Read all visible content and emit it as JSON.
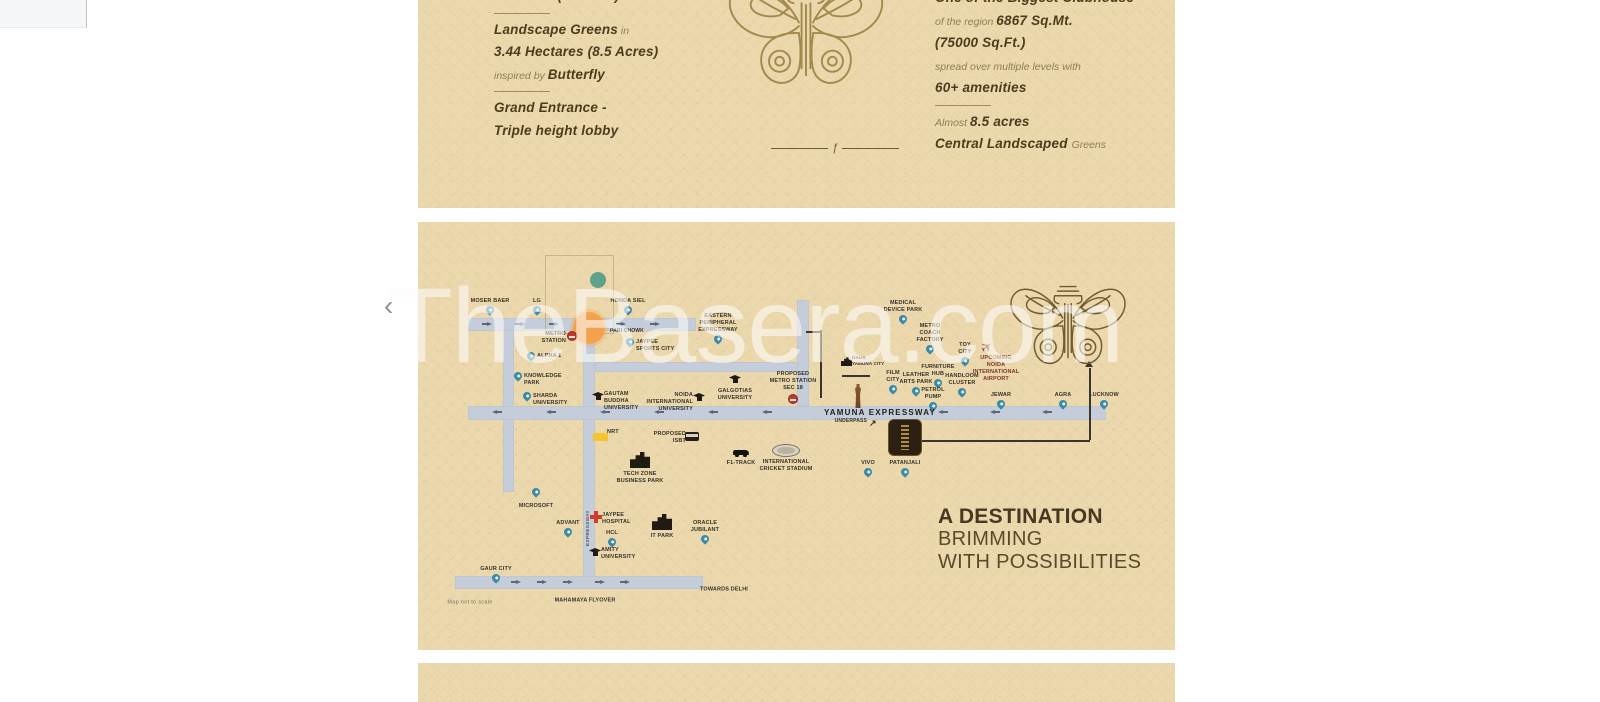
{
  "watermark": {
    "text": "TheBasera.com"
  },
  "carousel": {
    "prev": "‹"
  },
  "features": {
    "left": [
      {
        "bold": "7 Towers (Phase 1)"
      },
      {
        "tpl": "divider"
      },
      {
        "bold": "Landscape Greens",
        "post": " in"
      },
      {
        "bold": "3.44 Hectares (8.5 Acres)"
      },
      {
        "pre": "inspired by ",
        "bold": "Butterfly"
      },
      {
        "tpl": "divider"
      },
      {
        "bold": "Grand Entrance -"
      },
      {
        "bold": "Triple height lobby"
      }
    ],
    "right": [
      {
        "bold": "One of the Biggest Clubhouse"
      },
      {
        "pre": "of the region ",
        "bold": "6867 Sq.Mt."
      },
      {
        "bold": "(75000 Sq.Ft.)"
      },
      {
        "pre": "spread over multiple levels with"
      },
      {
        "bold": "60+ amenities"
      },
      {
        "tpl": "divider"
      },
      {
        "pre": "Almost ",
        "bold": "8.5 acres"
      },
      {
        "bold": "Central Landscaped ",
        "post": "Greens"
      }
    ]
  },
  "ornament": {
    "divider_glyph": "ƒ"
  },
  "map": {
    "headline": {
      "l1": "A DESTINATION",
      "l2": "BRIMMING",
      "l3": "WITH POSSIBILITIES"
    },
    "colors": {
      "card_beige": "#ecd8ad",
      "road": "#c4cdd9",
      "pin_teal": "#3c8aa5",
      "junction_orange": "#f2a24b",
      "metro_red": "#bf3a2c",
      "airport_maroon": "#7d3526",
      "ornament_gold": "#a28a4e",
      "logo_brown": "#6e5a33",
      "text_olive": "#4c3c1e"
    },
    "roads": [
      {
        "name": "road-parichowk-west",
        "x": 468,
        "y": 318,
        "w": 228,
        "h": 13
      },
      {
        "name": "road-main-vertical",
        "x": 583,
        "y": 330,
        "w": 12,
        "h": 252
      },
      {
        "name": "road-left-vertical",
        "x": 503,
        "y": 330,
        "w": 11,
        "h": 162
      },
      {
        "name": "road-mid-horizontal",
        "x": 595,
        "y": 362,
        "w": 203,
        "h": 10
      },
      {
        "name": "road-yamuna-expressway",
        "x": 468,
        "y": 406,
        "w": 638,
        "h": 14
      },
      {
        "name": "road-epe-vertical",
        "x": 797,
        "y": 300,
        "w": 12,
        "h": 106
      },
      {
        "name": "road-mahamaya",
        "x": 455,
        "y": 576,
        "w": 248,
        "h": 13
      },
      {
        "name": "sector-boundary",
        "x": 545,
        "y": 255,
        "w": 67,
        "h": 77,
        "cls": "boundary"
      },
      {
        "name": "rail-line-vertical",
        "x": 820,
        "y": 330,
        "w": 2,
        "h": 68,
        "cls": "dark"
      },
      {
        "name": "rail-line-horizontal",
        "x": 842,
        "y": 375,
        "w": 28,
        "h": 2,
        "cls": "dark"
      },
      {
        "name": "rail-line-top",
        "x": 806,
        "y": 331,
        "w": 15,
        "h": 2,
        "cls": "dark"
      },
      {
        "name": "connector-horizontal",
        "x": 922,
        "y": 440,
        "w": 168,
        "h": 2,
        "cls": "dark"
      },
      {
        "name": "connector-vertical",
        "x": 1089,
        "y": 368,
        "w": 2,
        "h": 72,
        "cls": "dark"
      },
      {
        "name": "connector-arrowhead",
        "x": 1085,
        "y": 361,
        "cls": "arr arr-u"
      },
      {
        "name": "arrow",
        "x": 487,
        "y": 322,
        "cls": "arr arr-r"
      },
      {
        "name": "arrow",
        "x": 520,
        "y": 322,
        "cls": "arr arr-r"
      },
      {
        "name": "arrow",
        "x": 554,
        "y": 322,
        "cls": "arr arr-r"
      },
      {
        "name": "arrow",
        "x": 621,
        "y": 322,
        "cls": "arr arr-r"
      },
      {
        "name": "arrow",
        "x": 655,
        "y": 322,
        "cls": "arr arr-r"
      },
      {
        "name": "arrow",
        "x": 492,
        "y": 410,
        "cls": "arr arr-l"
      },
      {
        "name": "arrow",
        "x": 546,
        "y": 410,
        "cls": "arr arr-l"
      },
      {
        "name": "arrow",
        "x": 600,
        "y": 410,
        "cls": "arr arr-l"
      },
      {
        "name": "arrow",
        "x": 654,
        "y": 410,
        "cls": "arr arr-l"
      },
      {
        "name": "arrow",
        "x": 708,
        "y": 410,
        "cls": "arr arr-l"
      },
      {
        "name": "arrow",
        "x": 762,
        "y": 410,
        "cls": "arr arr-l"
      },
      {
        "name": "arrow",
        "x": 938,
        "y": 410,
        "cls": "arr arr-l"
      },
      {
        "name": "arrow",
        "x": 990,
        "y": 410,
        "cls": "arr arr-l"
      },
      {
        "name": "arrow",
        "x": 1042,
        "y": 410,
        "cls": "arr arr-l"
      },
      {
        "name": "arrow",
        "x": 516,
        "y": 580,
        "cls": "arr arr-r"
      },
      {
        "name": "arrow",
        "x": 542,
        "y": 580,
        "cls": "arr arr-r"
      },
      {
        "name": "arrow",
        "x": 568,
        "y": 580,
        "cls": "arr arr-r"
      },
      {
        "name": "arrow",
        "x": 600,
        "y": 580,
        "cls": "arr arr-r"
      },
      {
        "name": "arrow",
        "x": 625,
        "y": 580,
        "cls": "arr arr-r"
      }
    ],
    "markers": [
      {
        "name": "pin-moser-baer",
        "icon": "pin",
        "x": 490,
        "y": 318,
        "lp": "la",
        "label": "MOSER BAER"
      },
      {
        "name": "pin-lg",
        "icon": "pin",
        "x": 537,
        "y": 318,
        "lp": "la",
        "label": "LG"
      },
      {
        "name": "pin-honda-siel",
        "icon": "pin",
        "x": 628,
        "y": 318,
        "lp": "la",
        "label": "HONDA SIEL"
      },
      {
        "name": "pari-chowk-junction",
        "icon": "ocirc",
        "x": 589,
        "y": 328,
        "lp": "lr",
        "cls": "pc t5",
        "label": "PARI CHOWK"
      },
      {
        "name": "sector-green-dot",
        "icon": "gcirc",
        "x": 598,
        "y": 280,
        "lp": "lc",
        "label": ""
      },
      {
        "name": "metro-station",
        "icon": "metro",
        "x": 572,
        "y": 342,
        "lp": "ll",
        "label": "METRO\nSTATION"
      },
      {
        "name": "pin-alpha-1",
        "icon": "pin",
        "x": 531,
        "y": 364,
        "lp": "lr",
        "label": "ALPHA 1"
      },
      {
        "name": "pin-knowledge-park",
        "icon": "pin",
        "x": 518,
        "y": 384,
        "lp": "lr",
        "label": "KNOWLEDGE\nPARK"
      },
      {
        "name": "pin-sharda-university",
        "icon": "pin",
        "x": 527,
        "y": 404,
        "lp": "lr",
        "label": "SHARDA\nUNIVERSITY"
      },
      {
        "name": "pin-jaypee-sports-city",
        "icon": "pin",
        "x": 630,
        "y": 350,
        "lp": "lr",
        "label": "JAYPEE\nSPORTS CITY"
      },
      {
        "name": "pin-eastern-peripheral-expressway",
        "icon": "pin",
        "x": 718,
        "y": 347,
        "lp": "la",
        "label": "EASTERN\nPERIPHERAL\nEXPRESSWAY"
      },
      {
        "name": "grad-gautam-buddha-university",
        "icon": "grad",
        "x": 598,
        "y": 402,
        "lp": "lr",
        "label": "GAUTAM\nBUDDHA\nUNIVERSITY"
      },
      {
        "name": "grad-noida-international-university",
        "icon": "grad",
        "x": 699,
        "y": 403,
        "lp": "ll",
        "label": "NOIDA\nINTERNATIONAL\nUNIVERSITY"
      },
      {
        "name": "grad-galgotias-university",
        "icon": "grad",
        "x": 735,
        "y": 385,
        "lp": "lb",
        "label": "GALGOTIAS\nUNIVERSITY"
      },
      {
        "name": "proposed-metro-station-sec-18",
        "icon": "metro",
        "x": 793,
        "y": 405,
        "lp": "la",
        "label": "PROPOSED\nMETRO STATION\nSEC 18"
      },
      {
        "name": "pin-medical-device-park",
        "icon": "pin",
        "x": 903,
        "y": 327,
        "lp": "la",
        "label": "MEDICAL\nDEVICE PARK"
      },
      {
        "name": "pin-metro-coach-factory",
        "icon": "pin",
        "x": 930,
        "y": 357,
        "lp": "la",
        "label": "METRO\nCOACH\nFACTORY"
      },
      {
        "name": "pin-toy-city",
        "icon": "pin",
        "x": 965,
        "y": 369,
        "lp": "la",
        "label": "TOY\nCITY"
      },
      {
        "name": "pin-furniture-hub",
        "icon": "pin",
        "x": 938,
        "y": 391,
        "lp": "la",
        "label": "FURNITURE\nHUB"
      },
      {
        "name": "pin-handloom-cluster",
        "icon": "pin",
        "x": 962,
        "y": 400,
        "lp": "la",
        "label": "HANDLOOM\nCLUSTER"
      },
      {
        "name": "pin-film-city",
        "icon": "pin",
        "x": 893,
        "y": 397,
        "lp": "la",
        "label": "FILM\nCITY"
      },
      {
        "name": "pin-leather-arts-park",
        "icon": "pin",
        "x": 916,
        "y": 399,
        "lp": "la",
        "label": "LEATHER\nARTS PARK"
      },
      {
        "name": "pin-petrol-pump",
        "icon": "pin",
        "x": 933,
        "y": 414,
        "lp": "la",
        "label": "PETROL\nPUMP"
      },
      {
        "name": "gaur-yamuna-city",
        "icon": "bldg-sm",
        "x": 846,
        "y": 366,
        "lp": "lr",
        "cls": "t4",
        "label": "GAUR\nYAMUNA CITY"
      },
      {
        "name": "statue",
        "icon": "statue",
        "x": 858,
        "y": 408,
        "lp": "lb",
        "label": ""
      },
      {
        "name": "upcoming-noida-international-airport",
        "icon": "plane",
        "x": 996,
        "y": 352,
        "lp": "lb",
        "cls": "maroon",
        "label": "UPCOMING\nNOIDA\nINTERNATIONAL\nAIRPORT"
      },
      {
        "name": "pin-jewar",
        "icon": "pin",
        "x": 1001,
        "y": 412,
        "lp": "la",
        "label": "JEWAR"
      },
      {
        "name": "pin-agra",
        "icon": "pin",
        "x": 1063,
        "y": 412,
        "lp": "la",
        "label": "AGRA"
      },
      {
        "name": "pin-lucknow",
        "icon": "pin",
        "x": 1104,
        "y": 412,
        "lp": "la",
        "label": "LUCKNOW"
      },
      {
        "name": "yamuna-expressway-label",
        "icon": "none",
        "x": 880,
        "y": 413,
        "lp": "lc",
        "cls": "expwy",
        "label": "YAMUNA EXPRESSWAY"
      },
      {
        "name": "underpass",
        "icon": "arrow-ne",
        "x": 873,
        "y": 429,
        "lp": "ll",
        "cls": "t5",
        "label": "UNDERPASS"
      },
      {
        "name": "pin-vivo",
        "icon": "pin",
        "x": 868,
        "y": 480,
        "lp": "la",
        "label": "VIVO"
      },
      {
        "name": "pin-patanjali",
        "icon": "pin",
        "x": 905,
        "y": 480,
        "lp": "la",
        "label": "PATANJALI"
      },
      {
        "name": "nrt-marker",
        "icon": "ysq",
        "x": 601,
        "y": 440,
        "lp": "lr",
        "label": "NRT"
      },
      {
        "name": "proposed-isbt",
        "icon": "bus",
        "x": 692,
        "y": 442,
        "lp": "ll",
        "label": "PROPOSED\nISBT"
      },
      {
        "name": "tech-zone-business-park",
        "icon": "bldg",
        "x": 640,
        "y": 468,
        "lp": "lb",
        "label": "TECH ZONE\nBUSINESS PARK"
      },
      {
        "name": "f1-track",
        "icon": "car",
        "x": 741,
        "y": 457,
        "lp": "lb",
        "label": "F1-TRACK"
      },
      {
        "name": "international-cricket-stadium",
        "icon": "stadium",
        "x": 786,
        "y": 456,
        "lp": "lb",
        "label": "INTERNATIONAL\nCRICKET STADIUM"
      },
      {
        "name": "pin-microsoft",
        "icon": "pin",
        "x": 536,
        "y": 500,
        "lp": "lb",
        "label": "MICROSOFT"
      },
      {
        "name": "pin-advant",
        "icon": "pin",
        "x": 568,
        "y": 540,
        "lp": "la",
        "label": "ADVANT"
      },
      {
        "name": "jaypee-hospital",
        "icon": "cross",
        "x": 596,
        "y": 523,
        "lp": "lr",
        "label": "JAYPEE\nHOSPITAL"
      },
      {
        "name": "pin-hcl",
        "icon": "pin",
        "x": 612,
        "y": 550,
        "lp": "la",
        "label": "HCL"
      },
      {
        "name": "grad-amity-university",
        "icon": "grad",
        "x": 595,
        "y": 558,
        "lp": "lr",
        "label": "AMITY\nUNIVERSITY"
      },
      {
        "name": "pin-oracle-jubilant",
        "icon": "pin",
        "x": 705,
        "y": 547,
        "lp": "la",
        "label": "ORACLE\nJUBILANT"
      },
      {
        "name": "it-park",
        "icon": "bldg",
        "x": 662,
        "y": 530,
        "lp": "lb",
        "label": "IT PARK"
      },
      {
        "name": "pin-gaur-city",
        "icon": "pin",
        "x": 496,
        "y": 586,
        "lp": "la",
        "label": "GAUR CITY"
      },
      {
        "name": "mahamaya-flyover-label",
        "icon": "none",
        "x": 585,
        "y": 601,
        "lp": "lc",
        "label": "MAHAMAYA FLYOVER"
      },
      {
        "name": "towards-delhi-label",
        "icon": "none",
        "x": 724,
        "y": 590,
        "lp": "lc",
        "label": "TOWARDS DELHI"
      },
      {
        "name": "map-scale-note",
        "icon": "none",
        "x": 470,
        "y": 603,
        "lp": "lc",
        "cls": "note",
        "label": "Map not to scale"
      },
      {
        "name": "expressway-vertical-label",
        "icon": "none",
        "x": 588,
        "y": 528,
        "lp": "lc",
        "cls": "vertlbl",
        "label": "EXPRESSWAY"
      }
    ]
  }
}
